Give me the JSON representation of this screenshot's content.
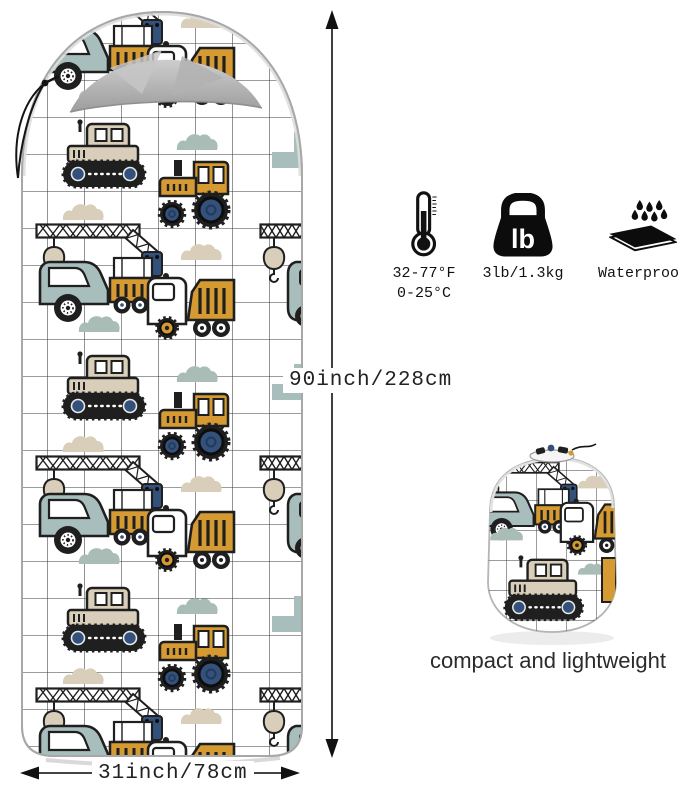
{
  "dimensions": {
    "height_label": "90inch/228cm",
    "width_label": "31inch/78cm"
  },
  "features": {
    "temperature": {
      "icon": "thermometer-icon",
      "line1": "32-77°F",
      "line2": "0-25°C"
    },
    "weight": {
      "icon": "kettlebell-weight-icon",
      "badge_text": "lb",
      "label": "3lb/1.3kg"
    },
    "waterproof": {
      "icon": "waterproof-mat-icon",
      "label": "Waterproof"
    }
  },
  "stuff_sack": {
    "caption": "compact and lightweight"
  },
  "pattern": {
    "theme": "construction vehicles print",
    "motifs": [
      "bulldozer",
      "tractor",
      "dump-truck",
      "crane-truck",
      "excavator",
      "clouds"
    ],
    "colors": {
      "ochre": "#D59A32",
      "navy": "#33517A",
      "sage": "#A8BEBD",
      "beige": "#D8CEB9",
      "grid": "#3A3A3A"
    }
  }
}
